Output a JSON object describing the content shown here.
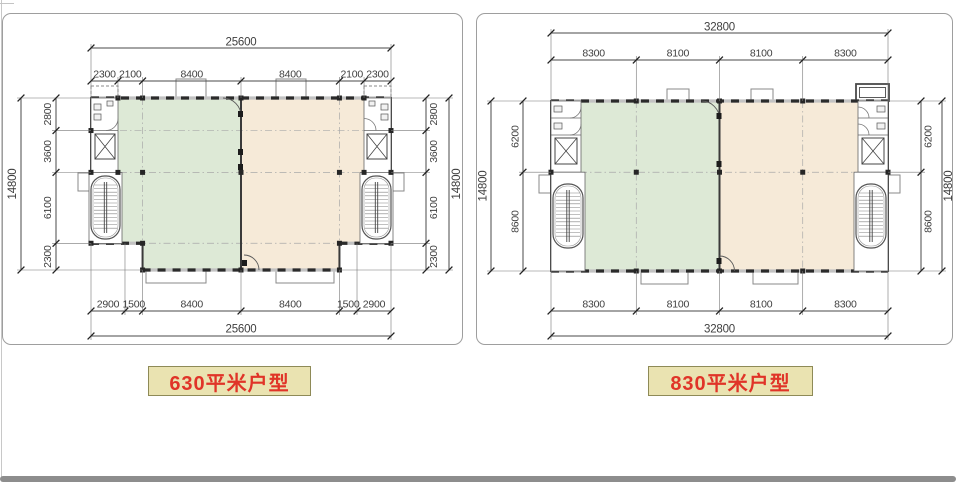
{
  "cards": [
    {
      "name": "plan-630",
      "caption": "630平米户型",
      "dims": {
        "overall_top": "25600",
        "overall_bottom": "25600",
        "overall_side": "14800",
        "top": [
          "2300",
          "2100",
          "8400",
          "8400",
          "2100",
          "2300"
        ],
        "bottom": [
          "2900",
          "1500",
          "8400",
          "8400",
          "1500",
          "2900"
        ],
        "side": [
          "2800",
          "3600",
          "6100",
          "2300"
        ]
      }
    },
    {
      "name": "plan-830",
      "caption": "830平米户型",
      "dims": {
        "overall_top": "32800",
        "overall_bottom": "32800",
        "overall_side": "14800",
        "top": [
          "8300",
          "8100",
          "8100",
          "8300"
        ],
        "bottom": [
          "8300",
          "8100",
          "8100",
          "8300"
        ],
        "side": [
          "6200",
          "8600"
        ]
      }
    }
  ],
  "colors": {
    "left_zone": "#dde9d6",
    "right_zone": "#f6ead8",
    "wall": "#3a3a3a",
    "wall_band": "#c2c2c2",
    "wall_dash": "#2b2b2b",
    "grid": "#a9a9a9",
    "dim_line": "#4a4a4a",
    "dim_tick": "#222222",
    "dim_text": "#3f3f3f",
    "symbol": "#555555",
    "card_border": "#9e9e9e",
    "caption_bg": "#eae3b1",
    "caption_border": "#8e8a57",
    "caption_text": "#e03428",
    "bottom_bar": "#8d8d8d"
  }
}
